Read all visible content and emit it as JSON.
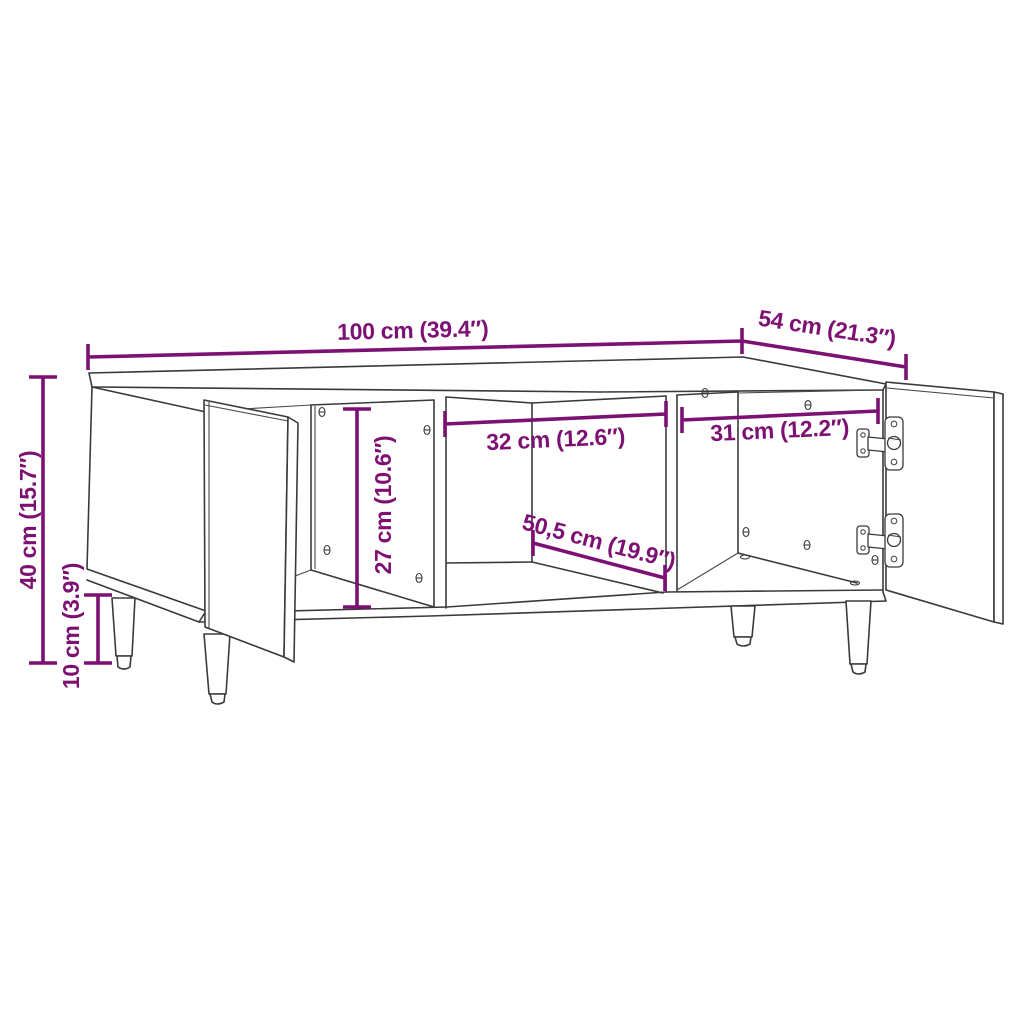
{
  "colors": {
    "dimension": "#7D1173",
    "line": "#3A3A3A",
    "background": "#FFFFFF"
  },
  "diagram": {
    "kind": "furniture dimension line drawing",
    "subject": "coffee table / TV cabinet with two open doors, open middle shelf and four legs"
  },
  "dimensions": {
    "width": {
      "label": "100 cm (39.4″)"
    },
    "depth": {
      "label": "54 cm (21.3″)"
    },
    "height": {
      "label": "40 cm (15.7″)"
    },
    "leg_height": {
      "label": "10 cm (3.9″)"
    },
    "compartment_height": {
      "label": "27 cm (10.6″)"
    },
    "middle_width": {
      "label": "32 cm (12.6″)"
    },
    "right_width": {
      "label": "31 cm (12.2″)"
    },
    "inner_depth": {
      "label": "50,5 cm (19.9″)"
    }
  }
}
